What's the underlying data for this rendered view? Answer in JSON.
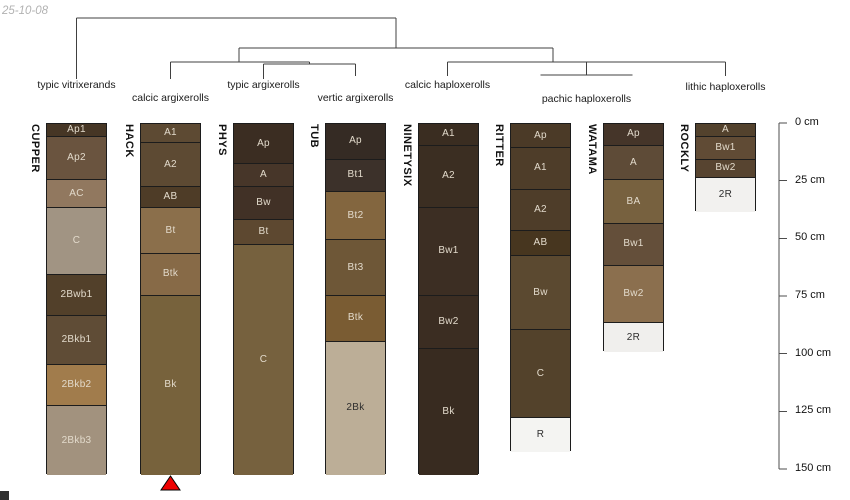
{
  "date_label": "25-10-08",
  "dendrogram": {
    "labels": [
      {
        "text": "typic vitrixerands",
        "x": 76.5,
        "y": 80
      },
      {
        "text": "calcic argixerolls",
        "x": 170.5,
        "y": 93
      },
      {
        "text": "typic argixerolls",
        "x": 263.5,
        "y": 80
      },
      {
        "text": "vertic argixerolls",
        "x": 355.5,
        "y": 93
      },
      {
        "text": "calcic haploxerolls",
        "x": 447.5,
        "y": 80
      },
      {
        "text": "pachic haploxerolls",
        "x": 586.5,
        "y": 94
      },
      {
        "text": "lithic haploxerolls",
        "x": 725.5,
        "y": 82
      }
    ],
    "segments": [
      [
        76.5,
        18,
        396,
        18
      ],
      [
        76.5,
        18,
        76.5,
        79
      ],
      [
        396,
        18,
        396,
        48
      ],
      [
        239,
        48,
        553,
        48
      ],
      [
        239,
        48,
        239,
        62
      ],
      [
        553,
        48,
        553,
        62
      ],
      [
        170.5,
        62,
        309.5,
        62
      ],
      [
        170.5,
        62,
        170.5,
        79
      ],
      [
        309.5,
        62,
        309.5,
        64
      ],
      [
        263.5,
        64,
        355.5,
        64
      ],
      [
        263.5,
        64,
        263.5,
        79
      ],
      [
        355.5,
        64,
        355.5,
        76
      ],
      [
        447.5,
        62,
        725.5,
        62
      ],
      [
        447.5,
        62,
        447.5,
        76
      ],
      [
        586.5,
        62,
        586.5,
        75
      ],
      [
        540.5,
        75,
        632.5,
        75
      ],
      [
        725.5,
        62,
        725.5,
        76
      ]
    ]
  },
  "profiles": [
    {
      "name": "CUPPER",
      "layers": [
        {
          "name": "Ap1",
          "top_cm": 0,
          "bottom_cm": 5,
          "color": "#463625",
          "dark_text": false
        },
        {
          "name": "Ap2",
          "top_cm": 5,
          "bottom_cm": 24,
          "color": "#6a543f",
          "dark_text": false
        },
        {
          "name": "AC",
          "top_cm": 24,
          "bottom_cm": 36,
          "color": "#91785f",
          "dark_text": false
        },
        {
          "name": "C",
          "top_cm": 36,
          "bottom_cm": 65,
          "color": "#a19483",
          "dark_text": false
        },
        {
          "name": "2Bwb1",
          "top_cm": 65,
          "bottom_cm": 83,
          "color": "#52402a",
          "dark_text": false
        },
        {
          "name": "2Bkb1",
          "top_cm": 83,
          "bottom_cm": 104,
          "color": "#5f4c36",
          "dark_text": false
        },
        {
          "name": "2Bkb2",
          "top_cm": 104,
          "bottom_cm": 122,
          "color": "#a17c4c",
          "dark_text": false
        },
        {
          "name": "2Bkb3",
          "top_cm": 122,
          "bottom_cm": 152,
          "color": "#a2927e",
          "dark_text": false
        }
      ]
    },
    {
      "name": "HACK",
      "layers": [
        {
          "name": "A1",
          "top_cm": 0,
          "bottom_cm": 8,
          "color": "#5d4a33",
          "dark_text": false
        },
        {
          "name": "A2",
          "top_cm": 8,
          "bottom_cm": 27,
          "color": "#5d4a33",
          "dark_text": false
        },
        {
          "name": "AB",
          "top_cm": 27,
          "bottom_cm": 36,
          "color": "#4e3c27",
          "dark_text": false
        },
        {
          "name": "Bt",
          "top_cm": 36,
          "bottom_cm": 56,
          "color": "#8b6f4b",
          "dark_text": false
        },
        {
          "name": "Btk",
          "top_cm": 56,
          "bottom_cm": 74,
          "color": "#876a47",
          "dark_text": false
        },
        {
          "name": "Bk",
          "top_cm": 74,
          "bottom_cm": 152,
          "color": "#77623c",
          "dark_text": false
        }
      ]
    },
    {
      "name": "PHYS",
      "layers": [
        {
          "name": "Ap",
          "top_cm": 0,
          "bottom_cm": 17,
          "color": "#3b2d22",
          "dark_text": false
        },
        {
          "name": "A",
          "top_cm": 17,
          "bottom_cm": 27,
          "color": "#473629",
          "dark_text": false
        },
        {
          "name": "Bw",
          "top_cm": 27,
          "bottom_cm": 41,
          "color": "#413126",
          "dark_text": false
        },
        {
          "name": "Bt",
          "top_cm": 41,
          "bottom_cm": 52,
          "color": "#5d4830",
          "dark_text": false
        },
        {
          "name": "C",
          "top_cm": 52,
          "bottom_cm": 152,
          "color": "#76613e",
          "dark_text": false
        }
      ]
    },
    {
      "name": "TUB",
      "layers": [
        {
          "name": "Ap",
          "top_cm": 0,
          "bottom_cm": 15,
          "color": "#352b24",
          "dark_text": false
        },
        {
          "name": "Bt1",
          "top_cm": 15,
          "bottom_cm": 29,
          "color": "#3c312a",
          "dark_text": false
        },
        {
          "name": "Bt2",
          "top_cm": 29,
          "bottom_cm": 50,
          "color": "#83663f",
          "dark_text": false
        },
        {
          "name": "Bt3",
          "top_cm": 50,
          "bottom_cm": 74,
          "color": "#6e5737",
          "dark_text": false
        },
        {
          "name": "Btk",
          "top_cm": 74,
          "bottom_cm": 94,
          "color": "#7a5c33",
          "dark_text": false
        },
        {
          "name": "2Bk",
          "top_cm": 94,
          "bottom_cm": 152,
          "color": "#bcae97",
          "dark_text": true
        }
      ]
    },
    {
      "name": "NINETYSIX",
      "layers": [
        {
          "name": "A1",
          "top_cm": 0,
          "bottom_cm": 9,
          "color": "#3a2d21",
          "dark_text": false
        },
        {
          "name": "A2",
          "top_cm": 9,
          "bottom_cm": 36,
          "color": "#3b2e22",
          "dark_text": false
        },
        {
          "name": "Bw1",
          "top_cm": 36,
          "bottom_cm": 74,
          "color": "#3c2e23",
          "dark_text": false
        },
        {
          "name": "Bw2",
          "top_cm": 74,
          "bottom_cm": 97,
          "color": "#3b2d22",
          "dark_text": false
        },
        {
          "name": "Bk",
          "top_cm": 97,
          "bottom_cm": 152,
          "color": "#382b20",
          "dark_text": false
        }
      ]
    },
    {
      "name": "RITTER",
      "layers": [
        {
          "name": "Ap",
          "top_cm": 0,
          "bottom_cm": 10,
          "color": "#4b3a27",
          "dark_text": false
        },
        {
          "name": "A1",
          "top_cm": 10,
          "bottom_cm": 28,
          "color": "#4e3d29",
          "dark_text": false
        },
        {
          "name": "A2",
          "top_cm": 28,
          "bottom_cm": 46,
          "color": "#4e3d29",
          "dark_text": false
        },
        {
          "name": "AB",
          "top_cm": 46,
          "bottom_cm": 57,
          "color": "#47361f",
          "dark_text": false
        },
        {
          "name": "Bw",
          "top_cm": 57,
          "bottom_cm": 89,
          "color": "#5b4930",
          "dark_text": false
        },
        {
          "name": "C",
          "top_cm": 89,
          "bottom_cm": 127,
          "color": "#53422b",
          "dark_text": false
        },
        {
          "name": "R",
          "top_cm": 127,
          "bottom_cm": 142,
          "color": "#f4f4f2",
          "dark_text": true
        }
      ]
    },
    {
      "name": "WATAMA",
      "layers": [
        {
          "name": "Ap",
          "top_cm": 0,
          "bottom_cm": 9,
          "color": "#453529",
          "dark_text": false
        },
        {
          "name": "A",
          "top_cm": 9,
          "bottom_cm": 24,
          "color": "#5e4b37",
          "dark_text": false
        },
        {
          "name": "BA",
          "top_cm": 24,
          "bottom_cm": 43,
          "color": "#77613f",
          "dark_text": false
        },
        {
          "name": "Bw1",
          "top_cm": 43,
          "bottom_cm": 61,
          "color": "#644f3a",
          "dark_text": false
        },
        {
          "name": "Bw2",
          "top_cm": 61,
          "bottom_cm": 86,
          "color": "#8b6f4e",
          "dark_text": false
        },
        {
          "name": "2R",
          "top_cm": 86,
          "bottom_cm": 99,
          "color": "#f0efed",
          "dark_text": true
        }
      ]
    },
    {
      "name": "ROCKLY",
      "layers": [
        {
          "name": "A",
          "top_cm": 0,
          "bottom_cm": 5,
          "color": "#53422d",
          "dark_text": false
        },
        {
          "name": "Bw1",
          "top_cm": 5,
          "bottom_cm": 15,
          "color": "#604b35",
          "dark_text": false
        },
        {
          "name": "Bw2",
          "top_cm": 15,
          "bottom_cm": 23,
          "color": "#574430",
          "dark_text": false
        },
        {
          "name": "2R",
          "top_cm": 23,
          "bottom_cm": 38,
          "color": "#f2f1ef",
          "dark_text": true
        }
      ]
    }
  ],
  "depth_axis": {
    "unit": "cm",
    "ticks": [
      {
        "cm": 0,
        "label": "0 cm"
      },
      {
        "cm": 25,
        "label": "25 cm"
      },
      {
        "cm": 50,
        "label": "50 cm"
      },
      {
        "cm": 75,
        "label": "75 cm"
      },
      {
        "cm": 100,
        "label": "100 cm"
      },
      {
        "cm": 125,
        "label": "125 cm"
      },
      {
        "cm": 150,
        "label": "150 cm"
      }
    ]
  },
  "marker": {
    "under_profile": "HACK",
    "shape": "triangle-up",
    "color": "#ee0000"
  }
}
